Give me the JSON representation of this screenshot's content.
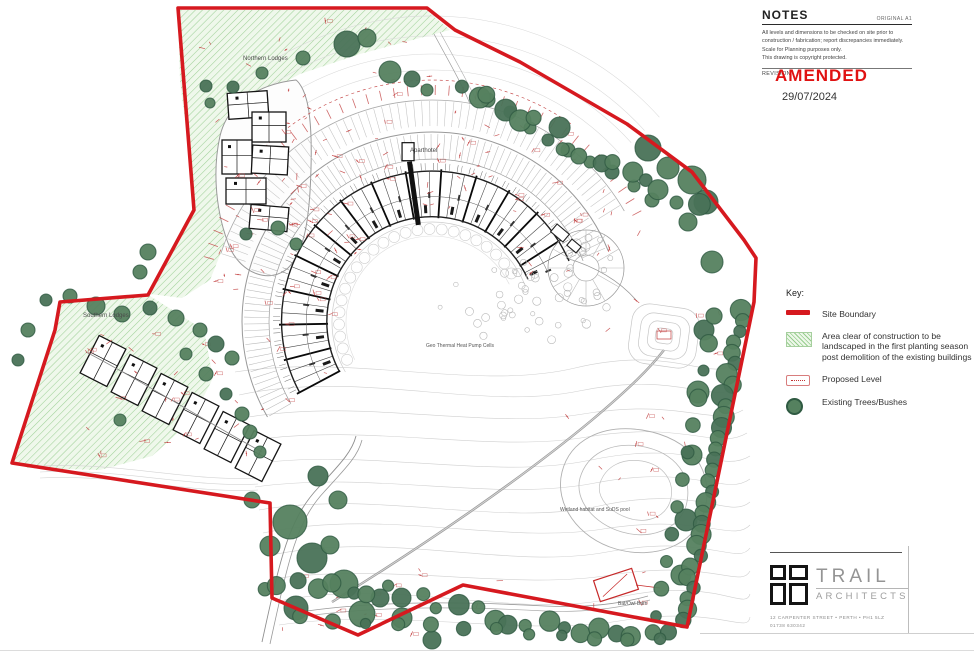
{
  "notes": {
    "title": "NOTES",
    "original": "ORIGINAL A1",
    "body_lines": [
      "All levels and dimensions to be checked on site prior to",
      "construction / fabrication; report discrepancies immediately.",
      "Scale for Planning purposes only.",
      "This drawing is copyright protected."
    ],
    "revision_label": "REVISION"
  },
  "stamp": {
    "amended": "AMENDED",
    "date": "29/07/2024"
  },
  "key": {
    "title": "Key:",
    "items": [
      {
        "type": "site-boundary",
        "label": "Site Boundary"
      },
      {
        "type": "clear-area",
        "label": "Area clear of construction to be landscaped in the first planting season post demolition of the existing buildings"
      },
      {
        "type": "proposed-level",
        "label": "Proposed Level"
      },
      {
        "type": "trees",
        "label": "Existing Trees/Bushes"
      }
    ]
  },
  "plan_labels": {
    "northern_lodges": "Northern Lodges",
    "aparthotel": "Aparthotel",
    "southern_lodges": "Southern Lodges",
    "geo_thermal": "Geo Thermal Heat Pump Cells",
    "wetland": "Wetland habitat and SuDS pool",
    "bat_owl_barn": "Bat/Owl Barn"
  },
  "title_block": {
    "name_primary": "TRAIL",
    "name_secondary": "ARCHITECTS",
    "address": "12 CARPENTER STREET • PERTH • PH1 5LZ",
    "phone": "01738 630342"
  },
  "colors": {
    "boundary": "#d6191f",
    "amended_red": "#e01212",
    "tree_fill": "#55815f",
    "tree_fill_alt": "#497257",
    "tree_stroke": "#2f5a42",
    "hatch_line": "#96cd8d",
    "hatch_bg": "#edf7e9",
    "red_mark": "#c03a3a"
  }
}
